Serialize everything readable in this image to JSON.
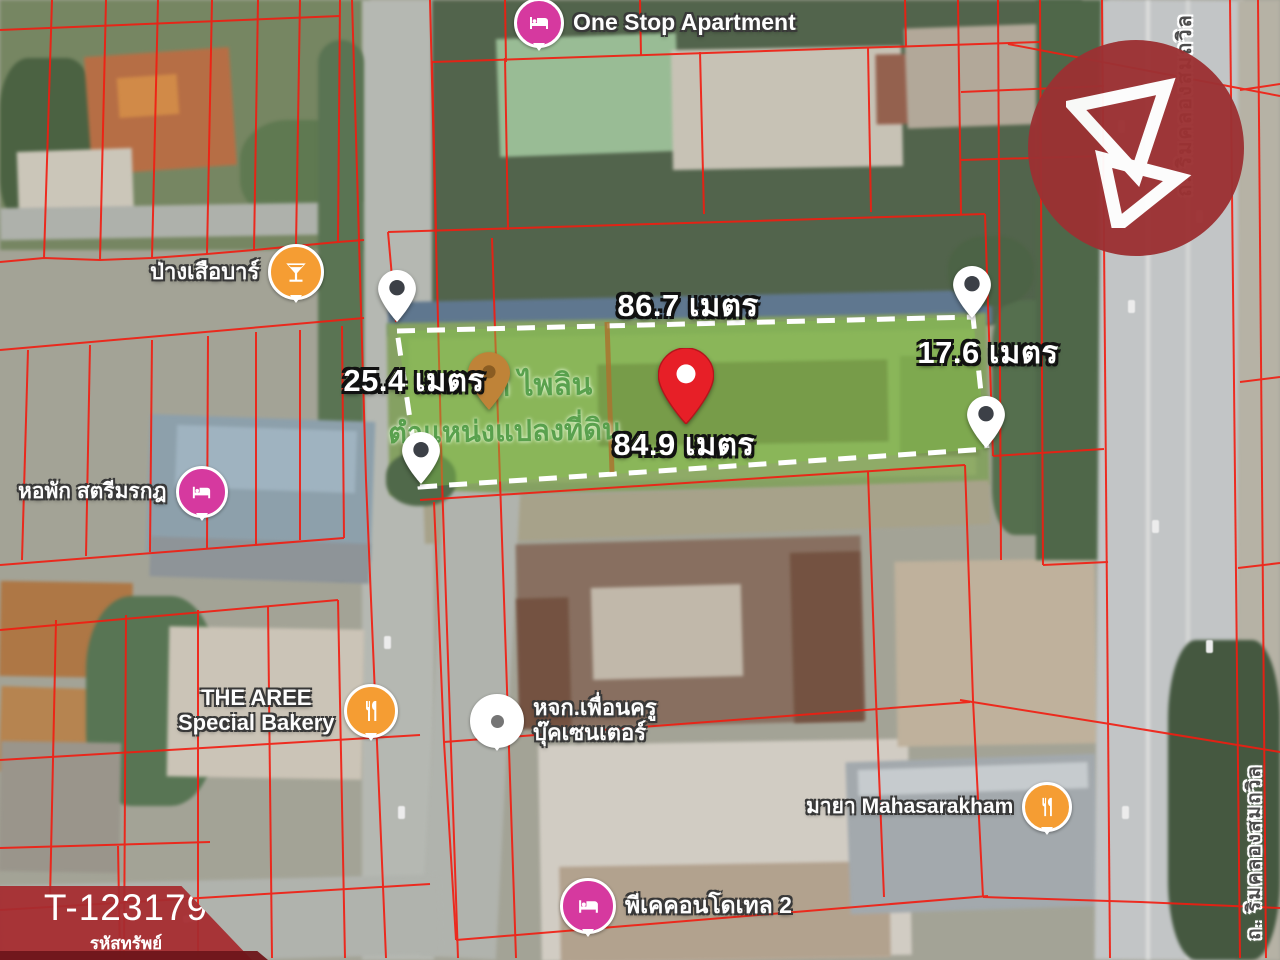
{
  "property_banner": {
    "code": "T-123179",
    "caption": "รหัสทรัพย์",
    "bg_color": "#a62c30"
  },
  "brand": {
    "logo_color": "#9c3133",
    "mark": "triangle-b-monogram"
  },
  "measurements": {
    "top": "86.7 เมตร",
    "left": "25.4 เมตร",
    "bottom": "84.9 เมตร",
    "right": "17.6 เมตร"
  },
  "plot": {
    "fill_color": "#7fc24a",
    "outline_color": "#ffffff",
    "watermark_line1": "ก ไพลิน",
    "watermark_line2": "ตำแหน่งแปลงที่ดิน"
  },
  "overlay": {
    "parcel_line_color": "#f21c10"
  },
  "pins": {
    "corner_color": "#ffffff",
    "target_color": "#e71f27",
    "secondary_color": "#bf8338"
  },
  "pois": {
    "one_stop": {
      "label": "One Stop Apartment",
      "icon": "bed-icon",
      "color": "#d6399f"
    },
    "pang_suea_bar": {
      "label": "ป่างเสือบาร์",
      "icon": "bar-icon",
      "color": "#f59d33"
    },
    "satri_morakot": {
      "label": "หอพัก สตรีมรกฎ",
      "icon": "bed-icon",
      "color": "#d6399f"
    },
    "the_aree": {
      "line1": "THE AREE",
      "line2": "Special Bakery",
      "icon": "restaurant-icon",
      "color": "#f59d33"
    },
    "puen_khru": {
      "line1": "หจก.เพื่อนครู",
      "line2": "บุ๊คเซนเตอร์",
      "icon": "place-dot-icon",
      "color": "#ffffff"
    },
    "maya": {
      "label": "มายา Mahasarakham",
      "icon": "restaurant-icon",
      "color": "#f59d33"
    },
    "pk_condotel": {
      "label": "พีเคคอนโดเทล 2",
      "icon": "bed-icon",
      "color": "#d6399f"
    }
  },
  "roads": {
    "right_top": "ถ. ริมคลองสมถวิล",
    "right_bottom": "ถ. ริมคลองสมถวิล"
  }
}
